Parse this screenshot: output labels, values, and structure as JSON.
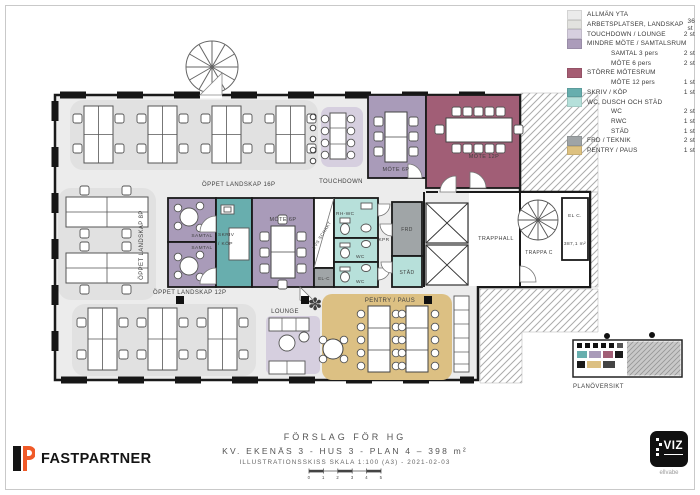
{
  "legend": {
    "items": [
      {
        "label": "ALLMÄN YTA",
        "count": "",
        "color": "#ebebeb"
      },
      {
        "label": "ARBETSPLATSER, LANDSKAP",
        "count": "36 st",
        "color": "#e2e2df"
      },
      {
        "label": "TOUCHDOWN / LOUNGE",
        "count": "2 st",
        "color": "#d6cfdf"
      },
      {
        "label": "MINDRE MÖTE / SAMTALSRUM",
        "count": "",
        "color": "#ab9cba"
      },
      {
        "label": "SAMTAL 3 pers",
        "count": "2 st",
        "color": ""
      },
      {
        "label": "MÖTE 6 pers",
        "count": "2 st",
        "color": ""
      },
      {
        "label": "STÖRRE MÖTESRUM",
        "count": "",
        "color": "#a55c72"
      },
      {
        "label": "MÖTE 12 pers",
        "count": "1 st",
        "color": ""
      },
      {
        "label": "SKRIV / KÖP",
        "count": "1 st",
        "color": "#67aeae"
      },
      {
        "label": "WC, DUSCH OCH STÄD",
        "count": "",
        "color": "#b5e0da"
      },
      {
        "label": "WC",
        "count": "2 st",
        "color": ""
      },
      {
        "label": "RWC",
        "count": "1 st",
        "color": ""
      },
      {
        "label": "STÄD",
        "count": "1 st",
        "color": ""
      },
      {
        "label": "FRD / TEKNIK",
        "count": "2 st",
        "color": "#9fa4a6"
      },
      {
        "label": "PENTRY / PAUS",
        "count": "1 st",
        "color": "#ddc180"
      }
    ]
  },
  "plan": {
    "labels": {
      "landskap16": "ÖPPET LANDSKAP 16P",
      "landskap8": "ÖPPET LANDSKAP 8P",
      "landskap12": "ÖPPET LANDSKAP 12P",
      "touchdown": "TOUCHDOWN",
      "mote6p_top": "MÖTE 6P",
      "mote12p": "MÖTE 12P",
      "samtal1": "SAMTAL",
      "samtal2": "SAMTAL",
      "skriv1": "SKRIV",
      "skriv2": "/ KÖP",
      "mote6p_mid": "MÖTE 6P",
      "vvs": "VVS SCHAKT",
      "elc_small": "EL-C",
      "rhwc": "RH-WC",
      "wc1": "WC",
      "wc2": "WC",
      "kpr": "KPR",
      "frd": "FRD",
      "stad": "STÄD",
      "trapphall": "TRAPPHALL",
      "trappac": "TRAPPA C",
      "elc": "EL C.",
      "area": "387,1 m²",
      "lounge": "LOUNGE",
      "pentry": "PENTRY / PAUS",
      "overview": "PLANÖVERSIKT"
    }
  },
  "icons": {
    "plant": "✽"
  },
  "title_block": {
    "line1": "FÖRSLAG FÖR HG",
    "line2": "KV. EKENÄS 3 - HUS 3 - PLAN 4 – 398 m²",
    "line3": "ILLUSTRATIONSSKISS SKALA 1:100 (A3) - 2021-02-03",
    "scale_ticks": [
      "0",
      "1",
      "2",
      "3",
      "4",
      "5"
    ]
  },
  "footer": {
    "brand": "FASTPARTNER",
    "viz_logo": "VIZ",
    "viz_sub": "ellvabe"
  },
  "colors": {
    "floor": "#ececec",
    "zone": "#e1e1e1",
    "lavender": "#d6cfdf",
    "purple": "#a99bb9",
    "maroon": "#a15e76",
    "teal": "#68aeae",
    "mint": "#b7e0da",
    "gray_room": "#a0a5a7",
    "tan": "#dcc083",
    "wall": "#1a1a1a",
    "accent_orange": "#f05a28"
  }
}
